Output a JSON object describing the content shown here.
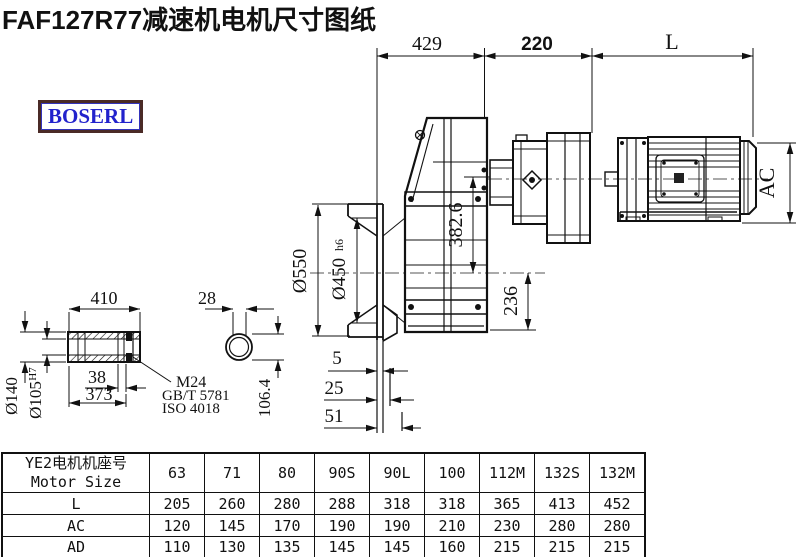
{
  "title": "FAF127R77减速机电机尺寸图纸",
  "logo": {
    "text": "BOSERL"
  },
  "drawing": {
    "dims": {
      "top_429": "429",
      "top_220": "220",
      "top_L": "L",
      "ac": "AC",
      "d550": "Ø550",
      "d450": "Ø450",
      "d450_suffix": "h6",
      "v382": "382.6",
      "v236": "236",
      "s5": "5",
      "s25": "25",
      "s51": "51",
      "shaft_410": "410",
      "shaft_28": "28",
      "shaft_38": "38",
      "shaft_373": "373",
      "d140": "Ø140",
      "d105": "Ø105",
      "d105_suffix": "H7",
      "v106": "106.4",
      "thread": "M24",
      "std1": "GB/T 5781",
      "std2": "ISO 4018"
    }
  },
  "table": {
    "header_cn": "YE2电机机座号",
    "header_en": "Motor Size",
    "columns": [
      "63",
      "71",
      "80",
      "90S",
      "90L",
      "100",
      "112M",
      "132S",
      "132M"
    ],
    "rows": [
      {
        "label": "L",
        "values": [
          "205",
          "260",
          "280",
          "288",
          "318",
          "318",
          "365",
          "413",
          "452"
        ]
      },
      {
        "label": "AC",
        "values": [
          "120",
          "145",
          "170",
          "190",
          "190",
          "210",
          "230",
          "280",
          "280"
        ]
      },
      {
        "label": "AD",
        "values": [
          "110",
          "130",
          "135",
          "145",
          "145",
          "160",
          "215",
          "215",
          "215"
        ]
      }
    ]
  }
}
